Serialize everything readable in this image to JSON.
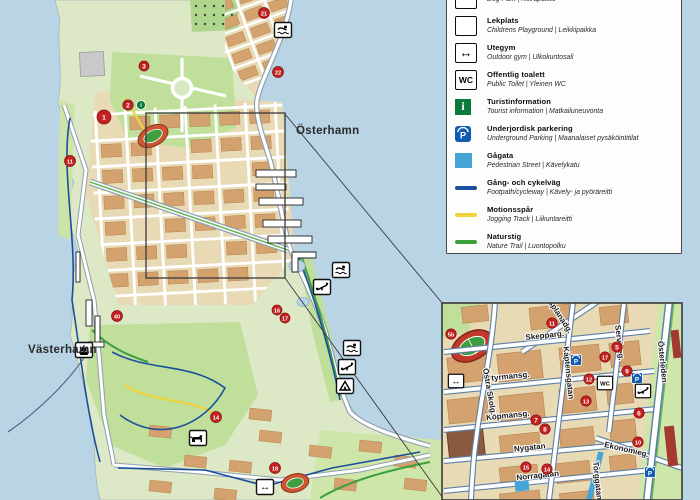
{
  "colors": {
    "water": "#b9d4e5",
    "land": "#dde9c6",
    "park": "#bfdf9b",
    "city_ground": "#e9dab6",
    "building": "#d4a26e",
    "building_edge": "#b5834e",
    "road_casing": "#8fa0ad",
    "inset_casing": "#5b7fa6",
    "footpath_blue": "#1c4f9c",
    "jogging_yellow": "#f0d23c",
    "nature_green": "#3da03d",
    "pedestrian_blue": "#45a5d6",
    "marker_red": "#c42222",
    "parking_blue": "#0f5cb0",
    "info_green": "#0a7a3c"
  },
  "legend": {
    "items": [
      {
        "id": "dog-park",
        "title": "",
        "subtitle": "Dog Park | Koirapuisto",
        "icon": "dog-park",
        "partially_cut": true
      },
      {
        "id": "playground",
        "title": "Lekplats",
        "subtitle": "Childrens Playground | Leikkipaikka",
        "icon": "playground"
      },
      {
        "id": "outdoor-gym",
        "title": "Utegym",
        "subtitle": "Outdoor gym | Ulkokuntosali",
        "icon": "outdoor-gym"
      },
      {
        "id": "public-toilet",
        "title": "Offentlig toalett",
        "subtitle": "Public Toilet | Yleinen WC",
        "icon": "wc"
      },
      {
        "id": "tourist-information",
        "title": "Turistinformation",
        "subtitle": "Tourist information | Matkailuneuvonta",
        "icon": "info"
      },
      {
        "id": "underground-parking",
        "title": "Underjordisk parkering",
        "subtitle": "Underground Parking | Maanalaiset pysäköintitilat",
        "icon": "parking"
      },
      {
        "id": "pedestrian-street",
        "title": "Gågata",
        "subtitle": "Pedestrian Street | Kävelykatu",
        "icon": "swatch-pedestrian"
      },
      {
        "id": "footpath-cycleway",
        "title": "Gång- och cykelväg",
        "subtitle": "Footpath/cycleway | Kävely- ja pyöräreitti",
        "icon": "line-footpath"
      },
      {
        "id": "jogging-track",
        "title": "Motionsspår",
        "subtitle": "Jogging Track | Liikuntareitti",
        "icon": "line-jogging"
      },
      {
        "id": "nature-trail",
        "title": "Naturstig",
        "subtitle": "Nature Trail | Luontopolku",
        "icon": "line-nature"
      }
    ]
  },
  "main_map": {
    "water_labels": [
      {
        "text": "Österhamn",
        "x": 296,
        "y": 134
      },
      {
        "text": "Västerhamn",
        "x": 28,
        "y": 353
      }
    ],
    "markers": [
      {
        "n": "1",
        "x": 104,
        "y": 117,
        "r": 7
      },
      {
        "n": "2",
        "x": 128,
        "y": 105,
        "r": 5.2
      },
      {
        "n": "3",
        "x": 144,
        "y": 66,
        "r": 5
      },
      {
        "n": "11",
        "x": 70,
        "y": 161,
        "r": 5.5
      },
      {
        "n": "21",
        "x": 264,
        "y": 13,
        "r": 5.5
      },
      {
        "n": "22",
        "x": 278,
        "y": 72,
        "r": 5.5
      },
      {
        "n": "40",
        "x": 117,
        "y": 316,
        "r": 5.5
      },
      {
        "n": "16",
        "x": 277,
        "y": 310,
        "r": 5
      },
      {
        "n": "17",
        "x": 285,
        "y": 318,
        "r": 5
      },
      {
        "n": "14",
        "x": 216,
        "y": 417,
        "r": 5.5
      },
      {
        "n": "18",
        "x": 275,
        "y": 468,
        "r": 5.5
      }
    ],
    "info_dot": {
      "x": 141,
      "y": 105
    },
    "icons": [
      {
        "type": "swim",
        "x": 283,
        "y": 30
      },
      {
        "type": "swim",
        "x": 341,
        "y": 270
      },
      {
        "type": "playground",
        "x": 322,
        "y": 287
      },
      {
        "type": "swim",
        "x": 352,
        "y": 348
      },
      {
        "type": "playground",
        "x": 347,
        "y": 367
      },
      {
        "type": "tent",
        "x": 345,
        "y": 386
      },
      {
        "type": "dog",
        "x": 198,
        "y": 438
      },
      {
        "type": "ferry",
        "x": 84,
        "y": 350
      },
      {
        "type": "gym",
        "x": 265,
        "y": 487
      }
    ]
  },
  "inset_map": {
    "streets": [
      {
        "name": "Esplanadg.",
        "x1": 600,
        "y1": 300,
        "x2": 522,
        "y2": 352,
        "lx": 557,
        "ly": 316,
        "rot": 57,
        "kind": "minor"
      },
      {
        "name": "Skepparg.",
        "x1": 444,
        "y1": 352,
        "x2": 650,
        "y2": 331,
        "lx": 545,
        "ly": 338,
        "rot": -6,
        "kind": "minor"
      },
      {
        "name": "Styrmansg.",
        "x1": 444,
        "y1": 392,
        "x2": 654,
        "y2": 371,
        "lx": 508,
        "ly": 379,
        "rot": -6,
        "kind": "minor"
      },
      {
        "name": "Köpmansg.",
        "x1": 444,
        "y1": 430,
        "x2": 656,
        "y2": 409,
        "lx": 508,
        "ly": 418,
        "rot": -6,
        "kind": "minor"
      },
      {
        "name": "Nygatan",
        "x1": 444,
        "y1": 461,
        "x2": 632,
        "y2": 444,
        "lx": 530,
        "ly": 450,
        "rot": -6,
        "kind": "minor"
      },
      {
        "name": "Norragatan",
        "x1": 444,
        "y1": 491,
        "x2": 652,
        "y2": 470,
        "lx": 538,
        "ly": 478,
        "rot": -6,
        "kind": "minor"
      },
      {
        "name": "Ekonomieg.",
        "x1": 596,
        "y1": 438,
        "x2": 682,
        "y2": 468,
        "lx": 626,
        "ly": 452,
        "rot": 13,
        "kind": "minor"
      },
      {
        "name": "Kaptensgatan",
        "x1": 573,
        "y1": 303,
        "x2": 549,
        "y2": 500,
        "lx": 566,
        "ly": 373,
        "rot": 84,
        "kind": "minor"
      },
      {
        "name": "Östra Skolg.",
        "x1": 495,
        "y1": 303,
        "x2": 471,
        "y2": 500,
        "lx": 487,
        "ly": 392,
        "rot": 80,
        "kind": "curvy"
      },
      {
        "name": "Serviceg.",
        "x1": 624,
        "y1": 303,
        "x2": 609,
        "y2": 432,
        "lx": 617,
        "ly": 343,
        "rot": 84,
        "kind": "minor"
      },
      {
        "name": "Österleden",
        "x1": 669,
        "y1": 303,
        "x2": 647,
        "y2": 500,
        "lx": 660,
        "ly": 362,
        "rot": 84,
        "kind": "major"
      },
      {
        "name": "Torggatan",
        "x1": 601,
        "y1": 452,
        "x2": 589,
        "y2": 500,
        "lx": 595,
        "ly": 481,
        "rot": 84,
        "kind": "pedestrian"
      }
    ],
    "markers": [
      {
        "n": "5b",
        "x": 451,
        "y": 334
      },
      {
        "n": "11",
        "x": 552,
        "y": 323
      },
      {
        "n": "17",
        "x": 605,
        "y": 357
      },
      {
        "n": "5",
        "x": 617,
        "y": 347
      },
      {
        "n": "9",
        "x": 627,
        "y": 371
      },
      {
        "n": "12",
        "x": 589,
        "y": 379
      },
      {
        "n": "13",
        "x": 586,
        "y": 401
      },
      {
        "n": "7",
        "x": 536,
        "y": 420
      },
      {
        "n": "8",
        "x": 545,
        "y": 429
      },
      {
        "n": "15",
        "x": 526,
        "y": 467
      },
      {
        "n": "14",
        "x": 547,
        "y": 469
      },
      {
        "n": "6",
        "x": 639,
        "y": 413
      },
      {
        "n": "10",
        "x": 638,
        "y": 442
      }
    ],
    "icons": [
      {
        "type": "gym",
        "x": 456,
        "y": 381
      },
      {
        "type": "wc",
        "x": 605,
        "y": 383
      },
      {
        "type": "parking",
        "x": 576,
        "y": 360
      },
      {
        "type": "parking",
        "x": 637,
        "y": 378
      },
      {
        "type": "parking",
        "x": 650,
        "y": 472
      },
      {
        "type": "playground",
        "x": 643,
        "y": 391
      }
    ]
  }
}
